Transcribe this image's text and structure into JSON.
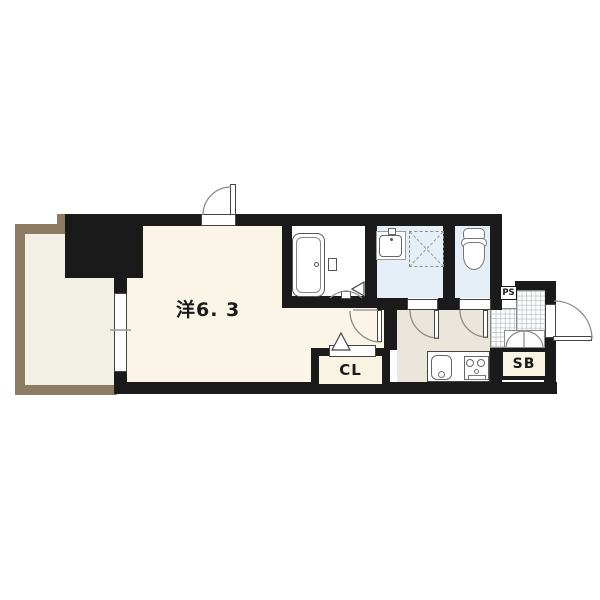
{
  "document": {
    "type": "apartment-floor-plan"
  },
  "labels": {
    "main_room": "洋6. 3",
    "closet": "CL",
    "shoe_box": "SB",
    "pipe_space": "PS"
  },
  "colors": {
    "wall": "#1a1a1a",
    "balcony-border": "#8d7c62",
    "balcony-floor": "#f2efe4",
    "room-floor": "#faf5e7",
    "hall-floor": "#eae6db",
    "wet-floor": "#e6eff7",
    "bath-floor": "#ffffff",
    "box-fill": "#f8f3e2",
    "tile-line": "#c5cad2",
    "line": "#8a8a8a",
    "fixture": "#555555"
  },
  "fixtures": [
    "bathtub",
    "bath-shelf",
    "bath-folding-door",
    "wash-basin",
    "washing-machine-space",
    "toilet",
    "kitchen-sink",
    "gas-stove",
    "window",
    "entrance-door",
    "room-door",
    "washroom-door",
    "toilet-door",
    "shoe-cabinet-doors",
    "closet-door-marker",
    "entrance-tile"
  ]
}
